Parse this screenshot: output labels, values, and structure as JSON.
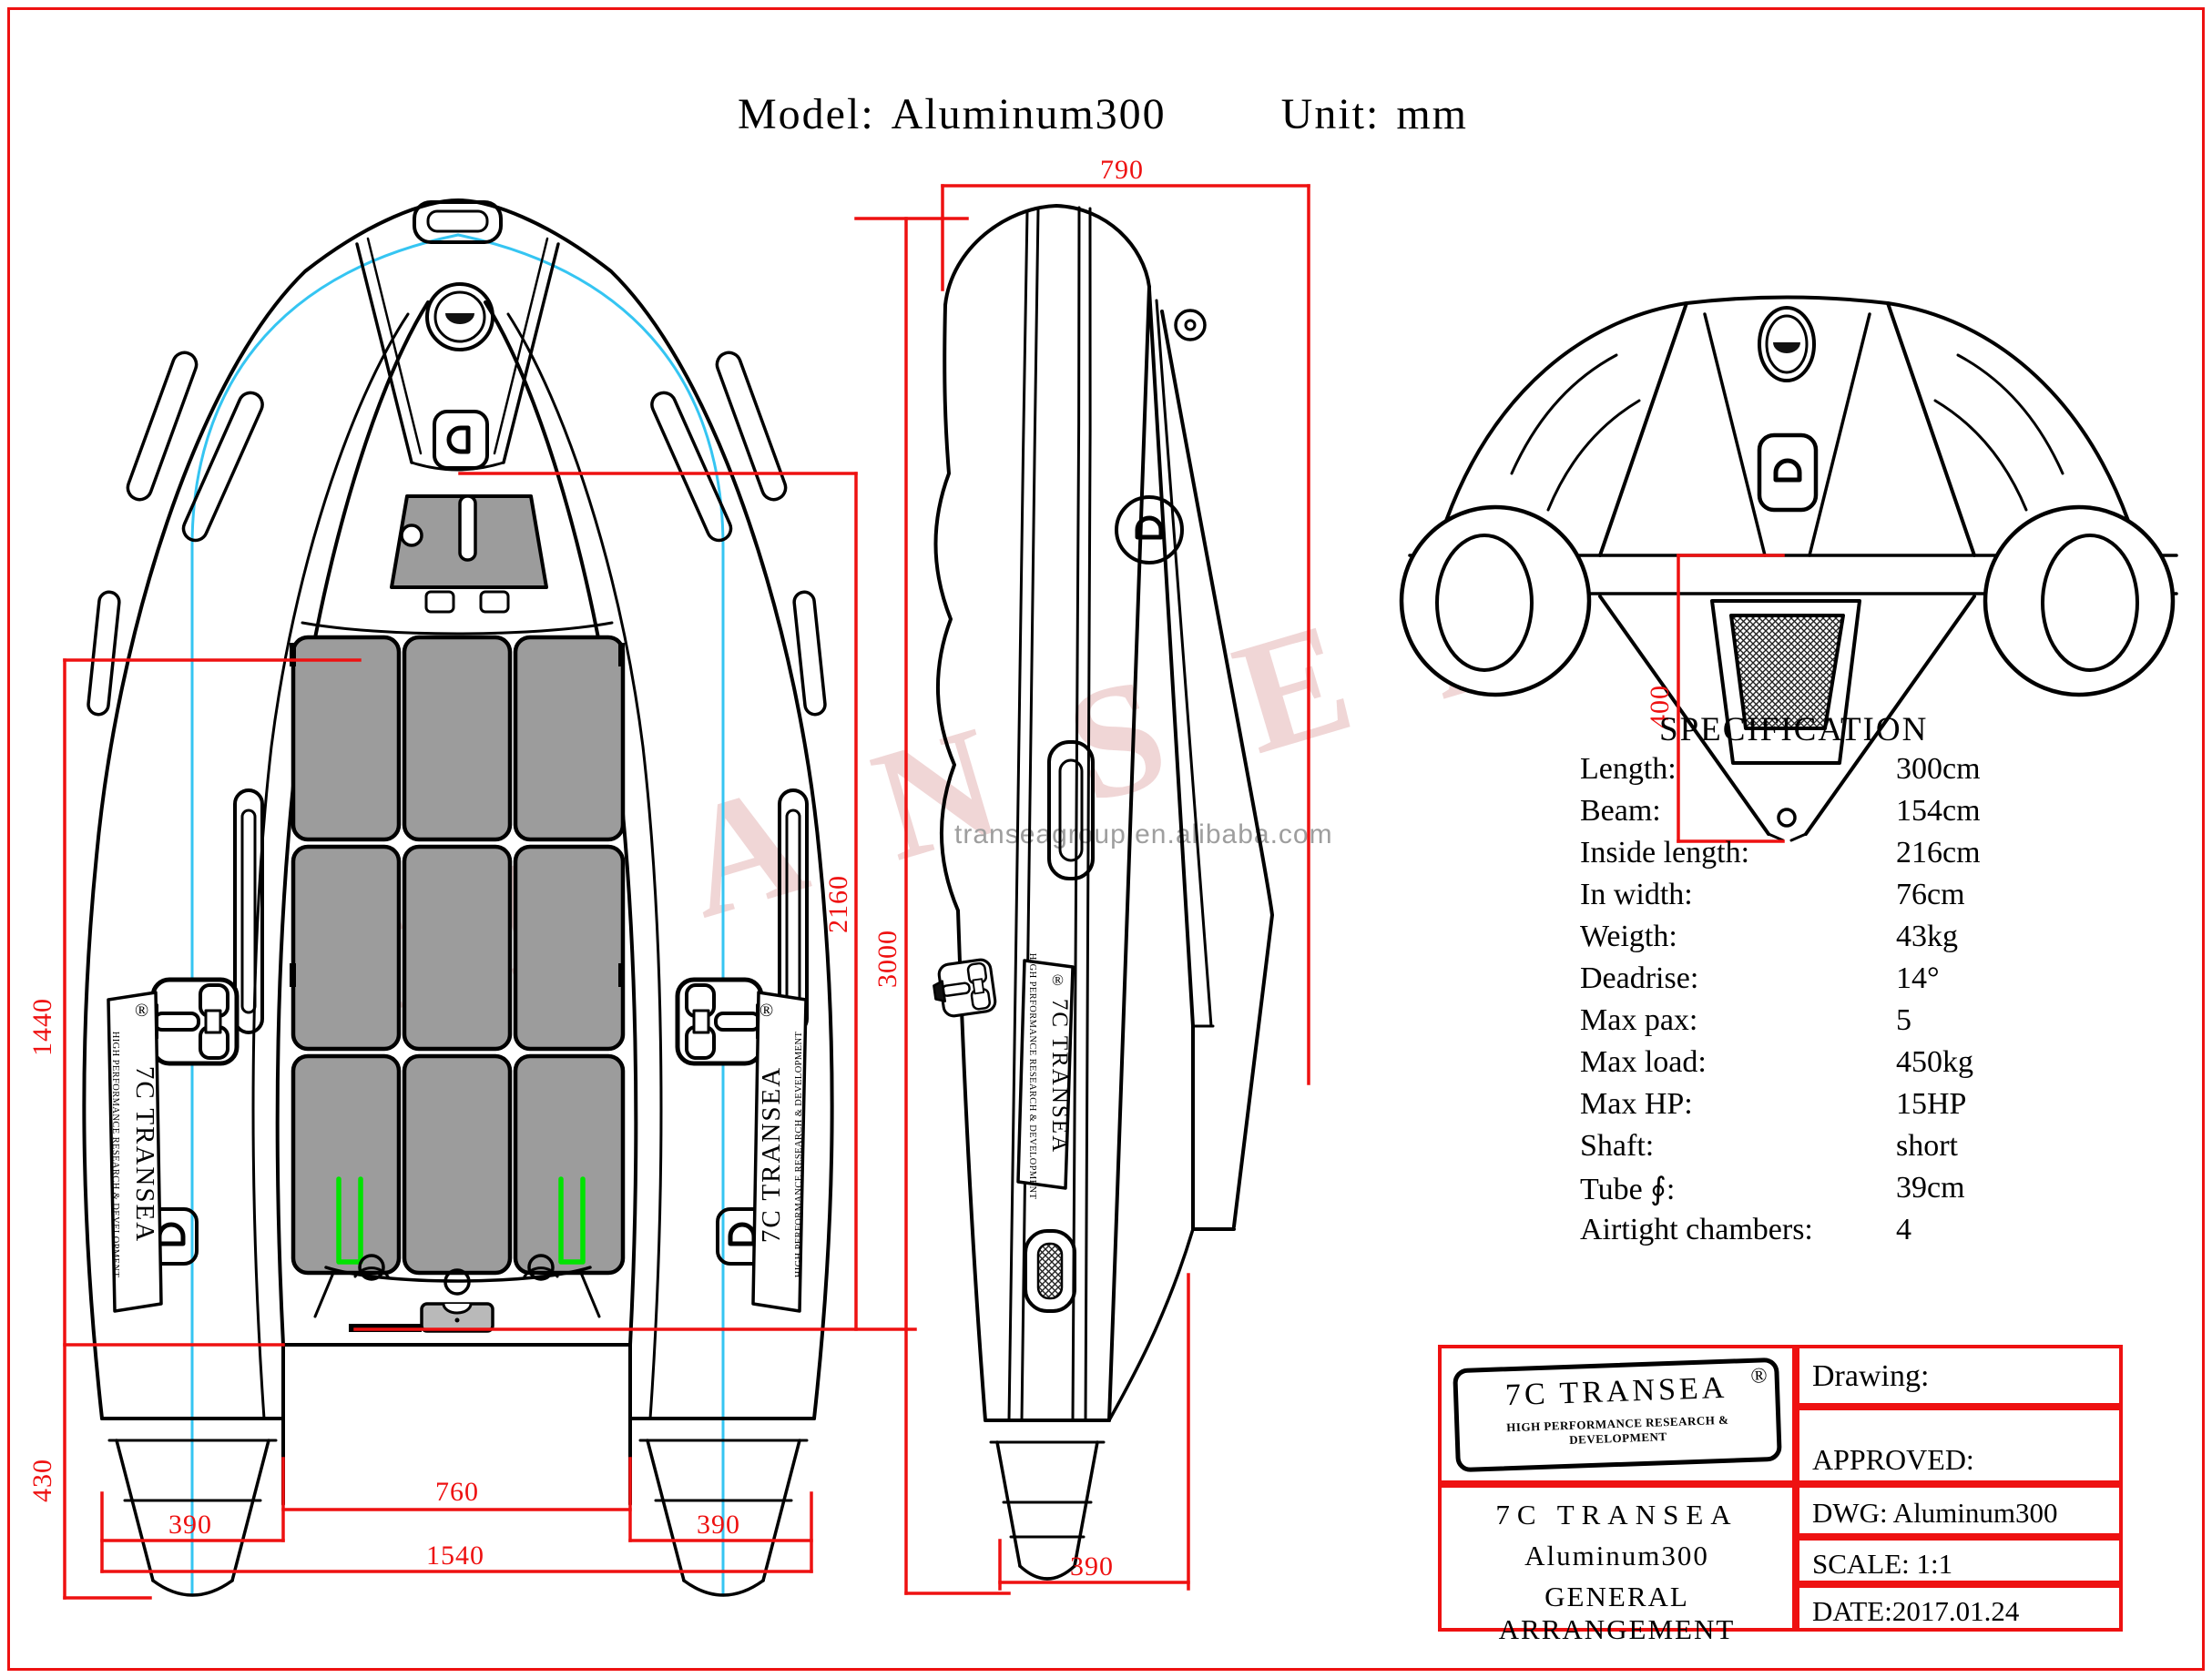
{
  "title": {
    "model_label": "Model:",
    "model_value": "Aluminum300",
    "unit_label": "Unit:",
    "unit_value": "mm"
  },
  "watermark": {
    "diagonal": "TRANSEA",
    "url": "transeagroup.en.alibaba.com"
  },
  "branding": {
    "name": "7C TRANSEA",
    "tagline": "HIGH PERFORMANCE RESEARCH & DEVELOPMENT",
    "registered": "®"
  },
  "colors": {
    "dimension_red": "#ee1111",
    "centerline_cyan": "#35c5f2",
    "clip_green": "#00e300",
    "panel_gray": "#9c9c9c",
    "watermark_pink": "#deA5a5",
    "watermark_gray": "#9e9e9e"
  },
  "dimensions": {
    "top_view": {
      "inside_width": "1440",
      "stern_height": "430",
      "inside_length": "2160",
      "tube_left": "390",
      "floor_width": "760",
      "tube_right": "390",
      "overall_width": "1540"
    },
    "side_view": {
      "bow_width": "790",
      "overall_length": "3000",
      "tube_diameter": "390"
    },
    "rear_view": {
      "transom_height": "400"
    }
  },
  "specification": {
    "title": "SPECIFICATION",
    "rows": [
      {
        "label": "Length:",
        "value": "300cm"
      },
      {
        "label": "Beam:",
        "value": "154cm"
      },
      {
        "label": "Inside length:",
        "value": "216cm"
      },
      {
        "label": "In width:",
        "value": "76cm"
      },
      {
        "label": "Weigth:",
        "value": "43kg"
      },
      {
        "label": "Deadrise:",
        "value": "14°"
      },
      {
        "label": "Max pax:",
        "value": "5"
      },
      {
        "label": "Max load:",
        "value": "450kg"
      },
      {
        "label": "Max HP:",
        "value": "15HP"
      },
      {
        "label": "Shaft:",
        "value": "short"
      },
      {
        "label": "Tube ∮:",
        "value": "39cm"
      },
      {
        "label": "Airtight chambers:",
        "value": "4"
      }
    ]
  },
  "title_block": {
    "drawing_label": "Drawing:",
    "approved_label": "APPROVED:",
    "dwg": "DWG: Aluminum300",
    "scale": "SCALE: 1:1",
    "date": "DATE:2017.01.24",
    "company": "7C TRANSEA",
    "model": "Aluminum300",
    "doc_type": "GENERAL ARRANGEMENT"
  }
}
